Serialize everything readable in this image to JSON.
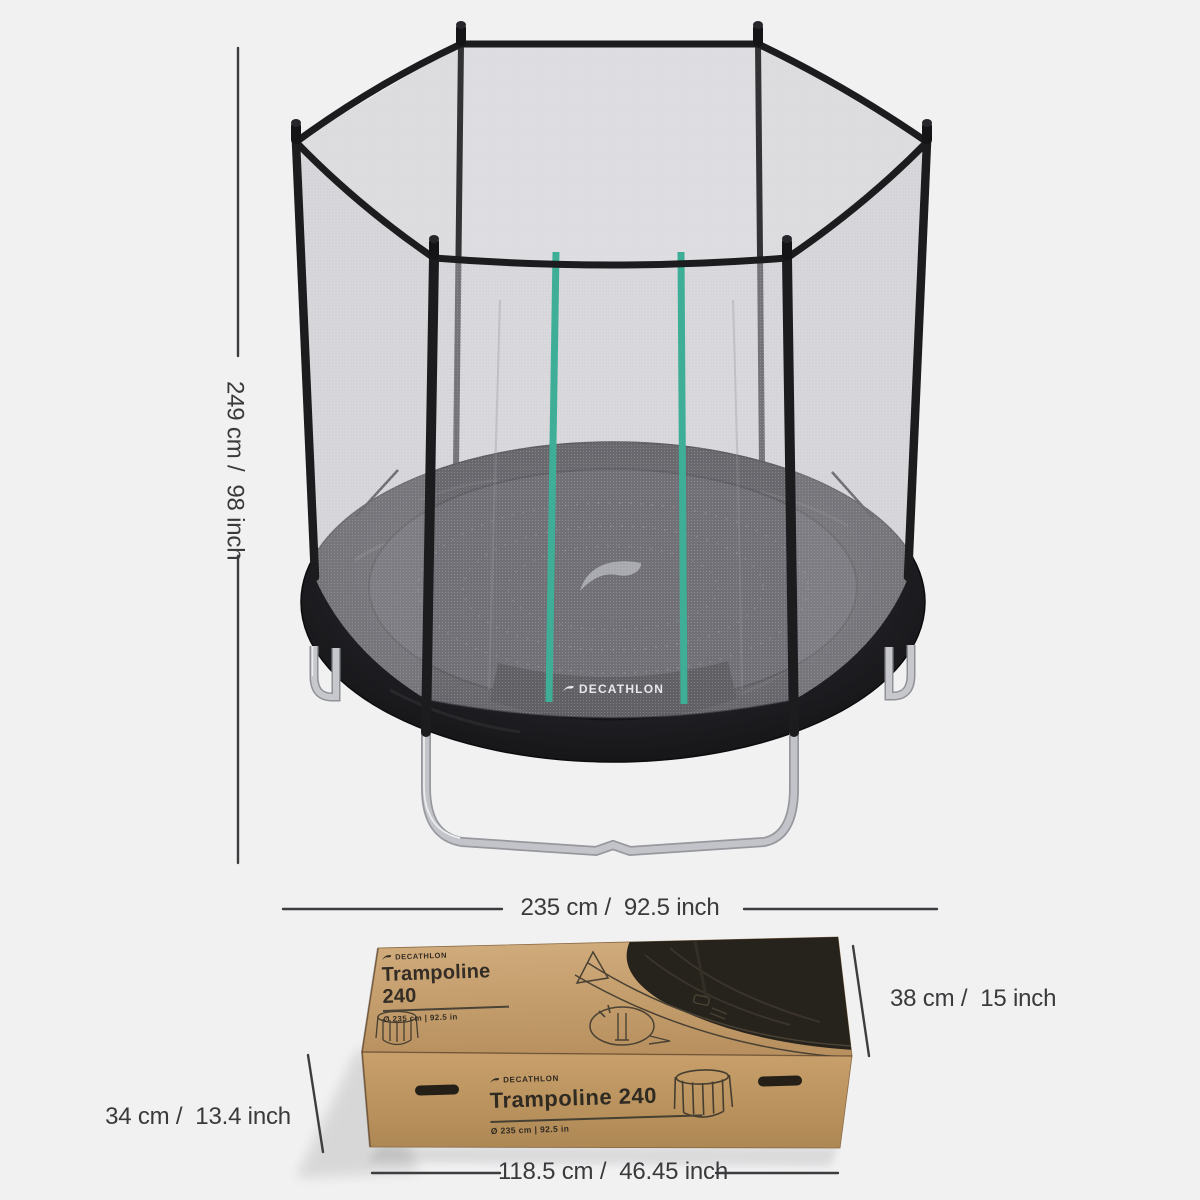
{
  "palette": {
    "background": "#f1f1f2",
    "dimension_line": "#3d3d40",
    "dimension_text": "#3a3a3c",
    "frame_black": "#1c1c1f",
    "net_gray": "#c8c8cd",
    "stripe_teal": "#3fae97",
    "mat_dark": "#2d2d33",
    "leg_silver": "#c2c4c9",
    "cardboard_top": "#cca673",
    "cardboard_front": "#c09a66",
    "print_ink": "#33302a"
  },
  "dimensions": {
    "trampoline_height": "249 cm /  98 inch",
    "trampoline_diameter": "235 cm /  92.5 inch",
    "box_height": "38 cm /  15 inch",
    "box_depth": "34 cm /  13.4 inch",
    "box_length": "118.5 cm /  46.45 inch"
  },
  "trampoline": {
    "mat_number": "240",
    "band_brand": "DECATHLON"
  },
  "box": {
    "top": {
      "brand": "DECATHLON",
      "title_line1": "Trampoline",
      "title_line2": "240",
      "spec": "Ø 235 cm | 92.5 in"
    },
    "front": {
      "brand": "DECATHLON",
      "title": "Trampoline 240",
      "spec": "Ø 235 cm | 92.5 in"
    }
  }
}
